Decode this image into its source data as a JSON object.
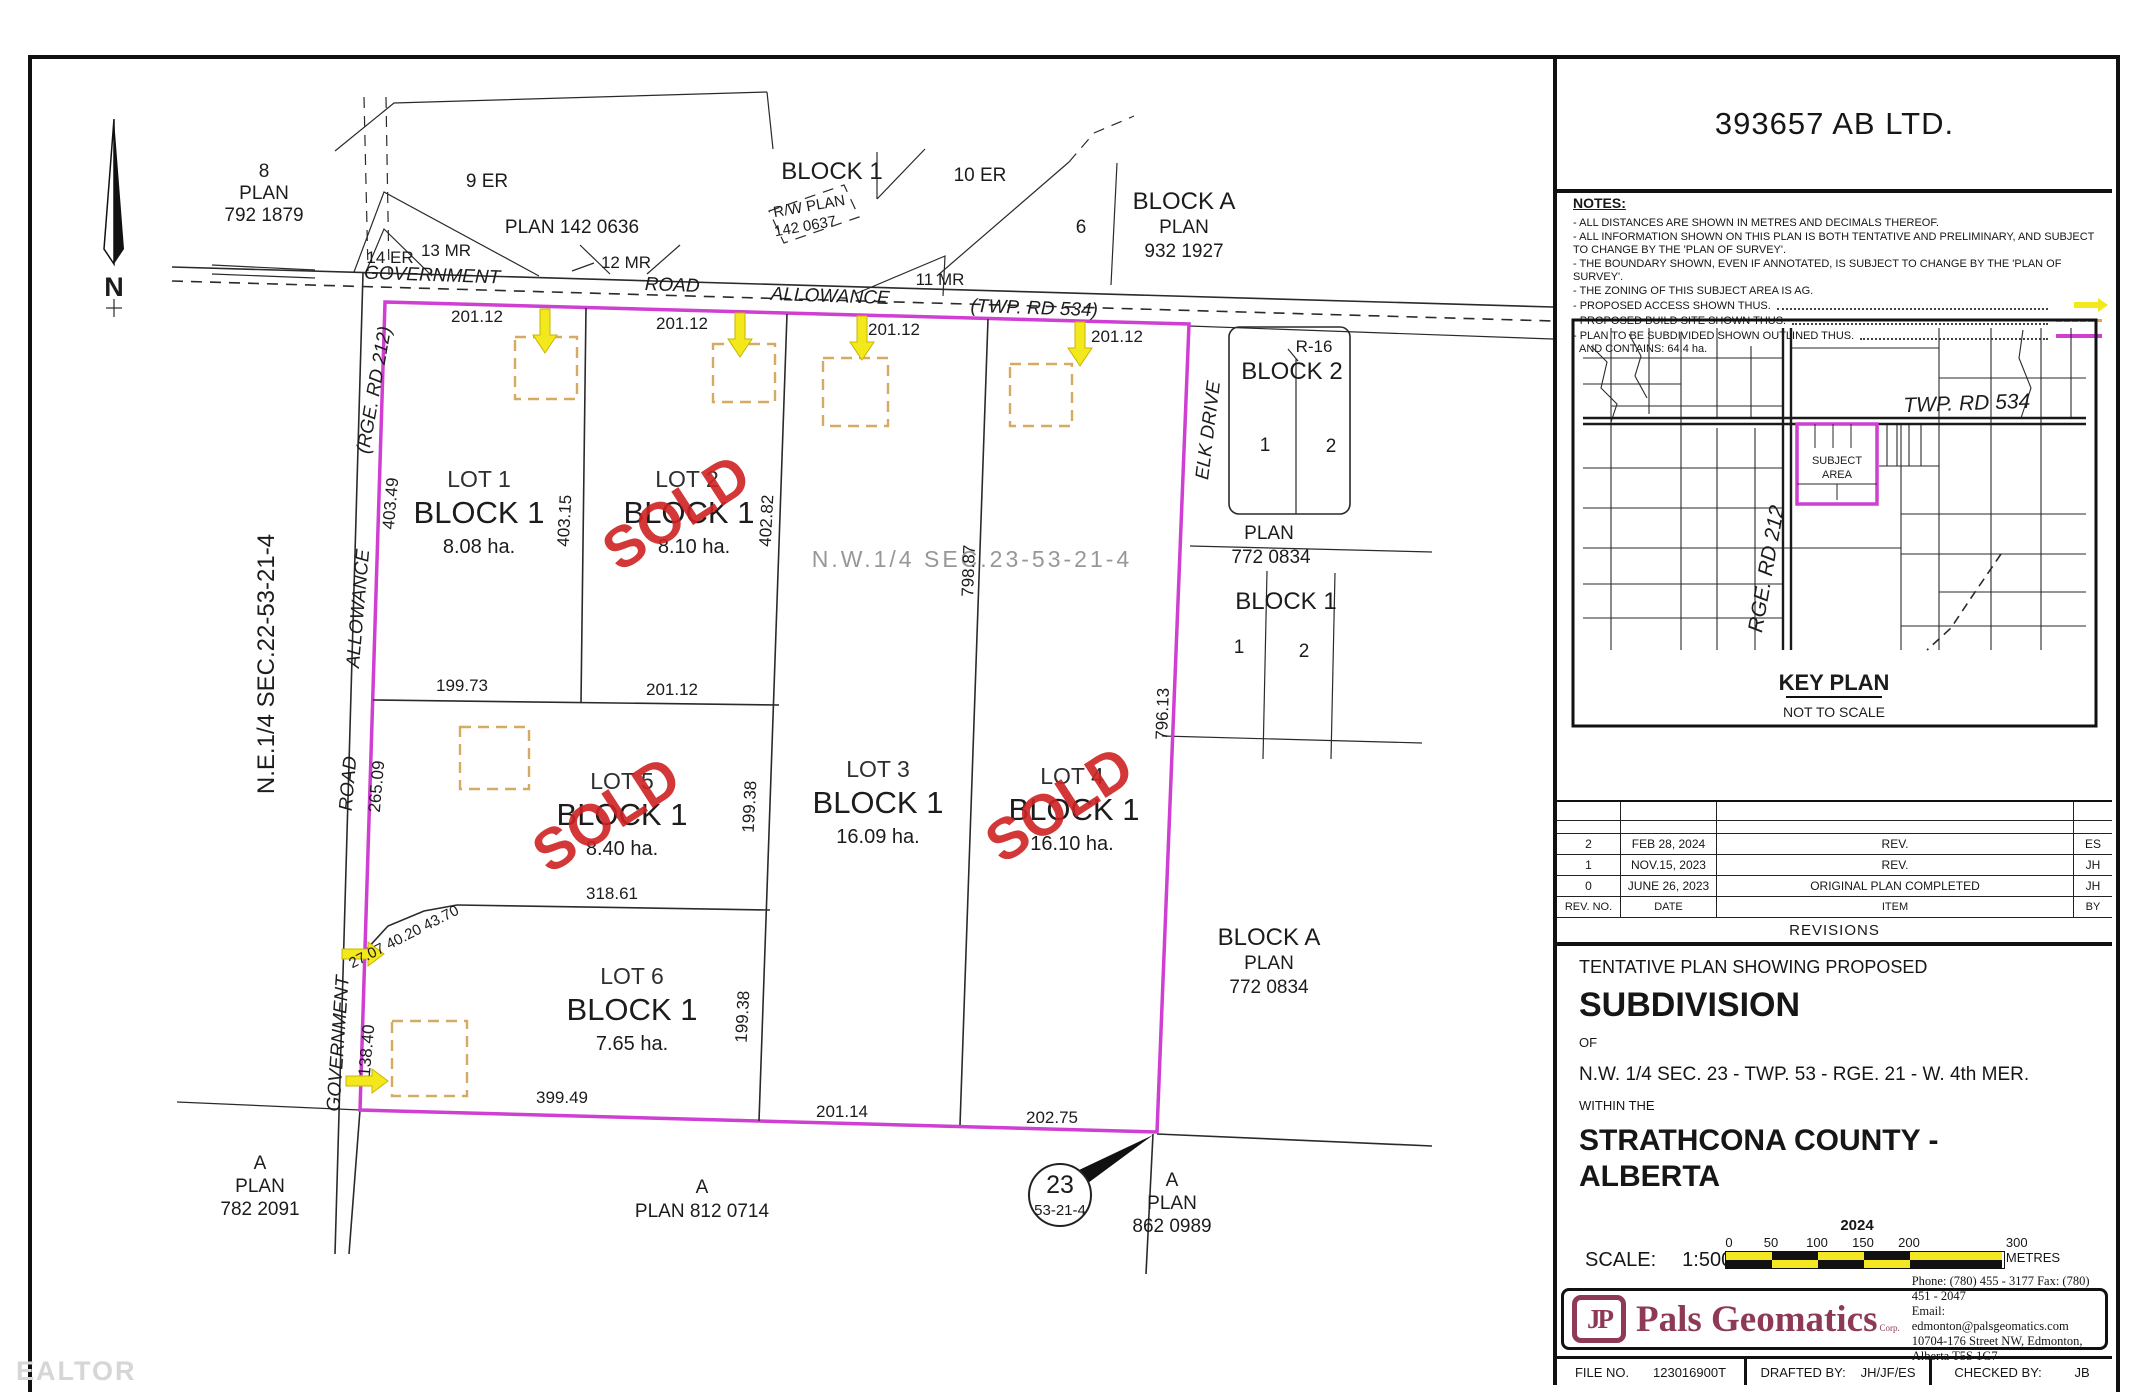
{
  "sheet": {
    "company": "393657 AB LTD."
  },
  "notes": {
    "heading": "NOTES:",
    "items": [
      "- ALL DISTANCES ARE SHOWN IN METRES AND DECIMALS THEREOF.",
      "- ALL INFORMATION SHOWN ON THIS PLAN IS BOTH TENTATIVE AND PRELIMINARY, AND SUBJECT TO CHANGE BY THE 'PLAN OF SURVEY'.",
      "- THE BOUNDARY SHOWN, EVEN IF ANNOTATED, IS SUBJECT TO CHANGE BY THE 'PLAN OF SURVEY'.",
      "- THE ZONING OF THIS SUBJECT AREA IS AG.",
      "- PROPOSED ACCESS SHOWN THUS.",
      "- PROPOSED BUILD SITE SHOWN THUS.",
      "- PLAN TO BE SUBDIVIDED SHOWN OUTLINED THUS.",
      "AND CONTAINS: 64.4 ha."
    ]
  },
  "key_plan": {
    "twp_rd": "TWP. RD 534",
    "rge_rd": "RGE. RD 212",
    "subject_1": "SUBJECT",
    "subject_2": "AREA",
    "title": "KEY PLAN",
    "subtitle": "NOT TO SCALE"
  },
  "revisions": {
    "title": "REVISIONS",
    "headers": {
      "no": "REV. NO.",
      "date": "DATE",
      "item": "ITEM",
      "by": "BY"
    },
    "rows": [
      {
        "no": "2",
        "date": "FEB 28, 2024",
        "item": "REV.",
        "by": "ES"
      },
      {
        "no": "1",
        "date": "NOV.15, 2023",
        "item": "REV.",
        "by": "JH"
      },
      {
        "no": "0",
        "date": "JUNE 26, 2023",
        "item": "ORIGINAL PLAN COMPLETED",
        "by": "JH"
      }
    ]
  },
  "title_block": {
    "line1": "TENTATIVE PLAN SHOWING PROPOSED",
    "line2": "SUBDIVISION",
    "line3": "OF",
    "line4": "N.W. 1/4 SEC. 23 - TWP. 53 - RGE. 21 - W. 4th MER.",
    "line5": "WITHIN THE",
    "line6": "STRATHCONA COUNTY - ALBERTA",
    "year": "2024",
    "scale_label": "SCALE:",
    "scale_value": "1:5000",
    "ticks": [
      "0",
      "50",
      "100",
      "150",
      "200",
      "300 METRES"
    ]
  },
  "brand": {
    "logo": "JP",
    "name": "Pals Geomatics",
    "corp": "Corp.",
    "phone": "Phone: (780) 455 - 3177   Fax: (780) 451 - 2047",
    "email": "Email: edmonton@palsgeomatics.com",
    "address": "10704-176 Street NW, Edmonton, Alberta T5S 1G7"
  },
  "file_bar": {
    "file_label": "FILE NO.",
    "file_no": "123016900T",
    "drafted_label": "DRAFTED BY:",
    "drafted_by": "JH/JF/ES",
    "checked_label": "CHECKED BY:",
    "checked_by": "JB"
  },
  "drawing": {
    "watermark": "EALTOR",
    "north": "N",
    "quarter_nw": "N.W.1/4  SEC.23-53-21-4",
    "quarter_ne": "N.E.1/4 SEC.22-53-21-4",
    "top_road": [
      "GOVERNMENT",
      "ROAD",
      "ALLOWANCE",
      "(TWP. RD 534)"
    ],
    "left_road": [
      "GOVERNMENT",
      "ROAD",
      "ALLOWANCE",
      "(RGE. RD 212)"
    ],
    "sold": "SOLD",
    "lots": {
      "lot1": {
        "name": "LOT 1",
        "block": "BLOCK 1",
        "area": "8.08 ha."
      },
      "lot2": {
        "name": "LOT 2",
        "block": "BLOCK 1",
        "area": "8.10 ha."
      },
      "lot3": {
        "name": "LOT 3",
        "block": "BLOCK 1",
        "area": "16.09 ha."
      },
      "lot4": {
        "name": "LOT 4",
        "block": "BLOCK 1",
        "area": "16.10 ha."
      },
      "lot5": {
        "name": "LOT 5",
        "block": "BLOCK 1",
        "area": "8.40 ha."
      },
      "lot6": {
        "name": "LOT 6",
        "block": "BLOCK 1",
        "area": "7.65 ha."
      }
    },
    "dims": {
      "top": [
        "201.12",
        "201.12",
        "201.12",
        "201.12"
      ],
      "west1": "403.49",
      "west2": "265.09",
      "west3": "138.40",
      "lot12": "403.15",
      "lot2e": "402.82",
      "mid_left": "199.73",
      "mid_right": "201.12",
      "lot3w_a": "199.38",
      "lot3w_b": "199.38",
      "lot34": "798.87",
      "east": "796.13",
      "lot56": "318.61",
      "chamfer": "27.07 40.20 43.70",
      "bottom": [
        "399.49",
        "201.14",
        "202.75"
      ]
    },
    "context": {
      "plan792": [
        "8",
        "PLAN",
        "792 1879"
      ],
      "er9": "9 ER",
      "plan142": "PLAN 142 0636",
      "block1_top": "BLOCK 1",
      "rw1": "R/W PLAN",
      "rw2": "142 0637",
      "er10": "10 ER",
      "parcel6": "6",
      "blocka932": [
        "BLOCK A",
        "PLAN",
        "932 1927"
      ],
      "er14": "14 ER",
      "mr13": "13 MR",
      "mr12": "12 MR",
      "mr11": "11 MR",
      "elk": "ELK DRIVE",
      "r16": "R-16",
      "block2": "BLOCK 2",
      "block2_lot1": "1",
      "block2_lot2": "2",
      "plan772": [
        "PLAN",
        "772 0834"
      ],
      "block1_e": "BLOCK 1",
      "block1e_lot1": "1",
      "block1e_lot2": "2",
      "blocka772": [
        "BLOCK A",
        "PLAN",
        "772 0834"
      ],
      "plan782": [
        "A",
        "PLAN",
        "782 2091"
      ],
      "plan812": [
        "A",
        "PLAN 812 0714"
      ],
      "sec_circle": [
        "23",
        "53-21-4"
      ],
      "plan862": [
        "A",
        "PLAN",
        "862 0989"
      ]
    }
  },
  "colors": {
    "boundary": "#ce3fd2",
    "access_arrow": "#f3e81c",
    "build_site": "#d5ab63",
    "sold": "#cf2222",
    "brand": "#8e3a55"
  }
}
